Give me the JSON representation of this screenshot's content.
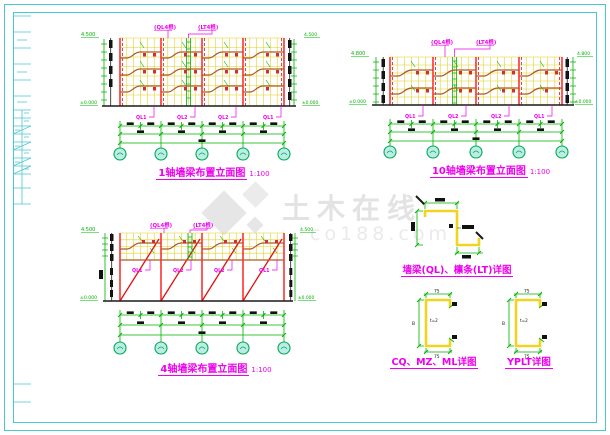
{
  "watermark": {
    "brand": "土木在线",
    "domain": "co188.com"
  },
  "drawings": {
    "d1": {
      "caption": "1轴墙梁布置立面图",
      "scale": "1:100",
      "top_label_1": "(QL4根)",
      "top_label_2": "(LT4根)",
      "elev_top": "4.500",
      "elev_bottom": "±0.000",
      "ql_labels": [
        "QL1",
        "QL2",
        "QL2",
        "QL1"
      ]
    },
    "d2": {
      "caption": "10轴墙梁布置立面图",
      "scale": "1:100",
      "top_label_1": "(QL4根)",
      "top_label_2": "(LT4根)",
      "elev_top": "4.800",
      "elev_bottom": "±0.000",
      "ql_labels": [
        "QL1",
        "QL2",
        "QL2",
        "QL1"
      ]
    },
    "d3": {
      "caption": "4轴墙梁布置立面图",
      "scale": "1:100",
      "top_label_1": "(QL4根)",
      "top_label_2": "(LT4根)",
      "elev_top": "4.500",
      "elev_bottom": "±0.000",
      "ql_labels": [
        "QL1",
        "QL2",
        "QL2",
        "QL1"
      ]
    }
  },
  "details": {
    "z_detail": {
      "caption": "墙梁(QL)、檩条(LT)详图"
    },
    "c_detail_1": {
      "caption": "CQ、MZ、ML详图"
    },
    "c_detail_2": {
      "caption": "YPLT详图"
    },
    "c_section": {
      "dim_top": "75",
      "dim_bottom": "75",
      "dim_height": "B",
      "thickness": "t=2"
    }
  },
  "colors": {
    "frame": "#49c8cf",
    "grid": "#e3cf1d",
    "dimension": "#00b400",
    "beam": "#b05a20",
    "axis_line": "#ff1515",
    "annotation": "#ee00ee",
    "section": "#f0d520",
    "watermark": "#d8d8d8"
  }
}
